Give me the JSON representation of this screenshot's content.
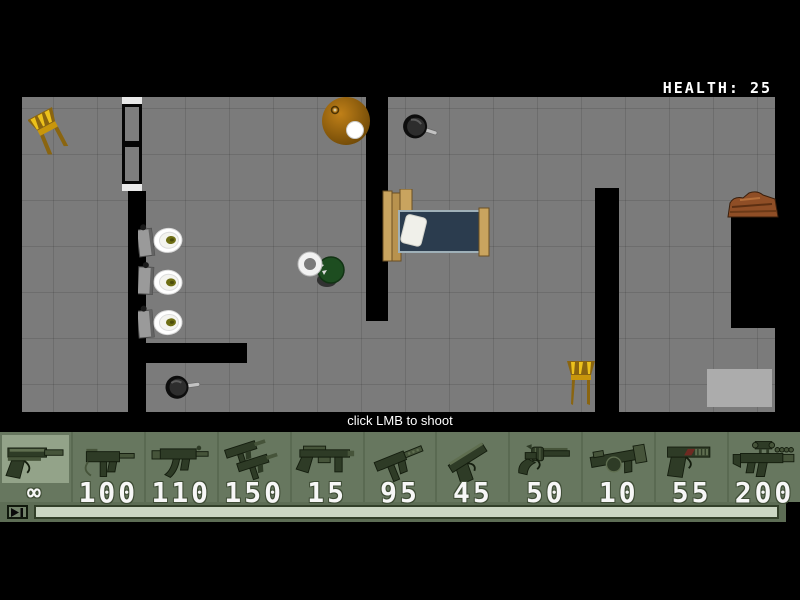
{
  "hud": {
    "health_label": "HEALTH:",
    "health_value": "25",
    "hint": "click LMB to shoot"
  },
  "weapon_bar": {
    "slots": [
      {
        "name": "desert-eagle-pistol",
        "ammo": "∞",
        "selected": true
      },
      {
        "name": "mac10-smg",
        "ammo": "100",
        "selected": false
      },
      {
        "name": "mp5-smg",
        "ammo": "110",
        "selected": false
      },
      {
        "name": "dual-uzi",
        "ammo": "150",
        "selected": false
      },
      {
        "name": "pump-shotgun",
        "ammo": "15",
        "selected": false
      },
      {
        "name": "tec9-machine-pistol",
        "ammo": "95",
        "selected": false
      },
      {
        "name": "colt-pistol",
        "ammo": "45",
        "selected": false
      },
      {
        "name": "revolver",
        "ammo": "50",
        "selected": false
      },
      {
        "name": "grenade-launcher",
        "ammo": "10",
        "selected": false
      },
      {
        "name": "compact-pistol",
        "ammo": "55",
        "selected": false
      },
      {
        "name": "scoped-rifle",
        "ammo": "200",
        "selected": false
      }
    ]
  },
  "map": {
    "objects": [
      "chair",
      "toilet",
      "round-table",
      "frying-pan",
      "bed",
      "player",
      "wood-pile",
      "rug",
      "door"
    ]
  },
  "colors": {
    "floor": "#7b7b7b",
    "wall": "#000000",
    "bar_bg": "#67775f",
    "bar_selected": "#93a389",
    "track_fill": "#cbd6c3",
    "wood": "#c9a45f",
    "chair_gold": "#e0ac16",
    "mattress": "#2b3c4e",
    "health_text": "#ffffff"
  }
}
